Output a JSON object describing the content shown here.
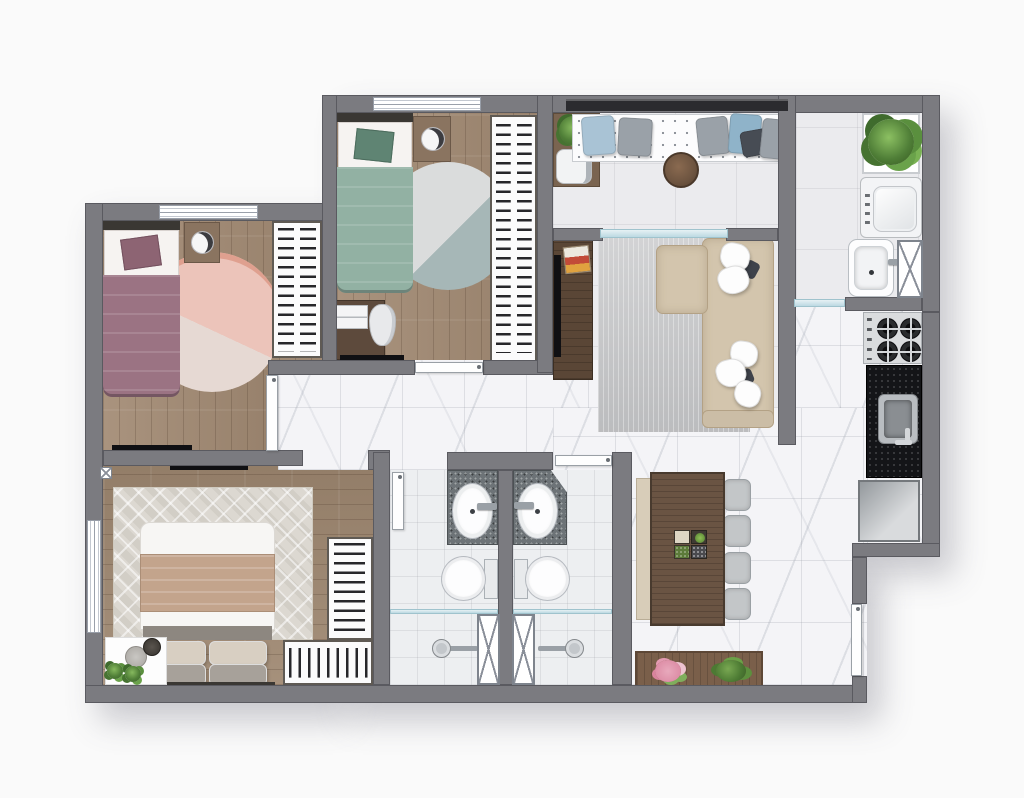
{
  "meta": {
    "type": "apartment-floor-plan",
    "view": "top-down furnished rendering",
    "canvas": {
      "width": 1024,
      "height": 798
    },
    "text_visible": "none"
  },
  "palette": {
    "background": "#fafafa",
    "walls": "#7b7b80",
    "wood_floor": "#a28a73",
    "marble_floor": "#f4f4f7",
    "plain_tile": "#ebebee",
    "bath_tile": "#edeff1",
    "bed1_mauve": "#9b7383",
    "bed2_green": "#92b1a3",
    "master_blanket_tan": "#c3a48c",
    "sofa_beige": "#d3c5ad",
    "living_rug_gray": "#c7c8ca",
    "rug_pink": "#eec6bc",
    "rug_teal": "#a6b7b7",
    "dining_table_walnut": "#6a5443",
    "granite_vanity": "#6d7377",
    "kitchen_counter_black": "#141518",
    "glass_partition": "#bcd9e2",
    "plants_green": "#4f7e37",
    "flowers_pink": "#e8a0b4"
  },
  "rooms": [
    {
      "id": "bedroom-1",
      "position": "top-left",
      "floor": "wood",
      "contents": [
        "single-bed-mauve",
        "white-pillow-with-mauve-cushion",
        "dark-headboard",
        "nightstand-with-round-lamp",
        "round-rug-pink-two-tone",
        "open-wardrobe-hanging-clothes",
        "wall-tv",
        "window-top-wall",
        "door-to-hallway"
      ]
    },
    {
      "id": "bedroom-2",
      "position": "top-middle",
      "floor": "wood",
      "contents": [
        "single-bed-green",
        "white-pillow-with-green-cushion",
        "dark-headboard",
        "nightstand-with-round-lamp",
        "round-rug-gray-teal",
        "open-wardrobe-hanging-clothes",
        "desk-with-white-chair-and-books",
        "wall-tv",
        "window-top-wall",
        "door-to-hallway"
      ]
    },
    {
      "id": "master-bedroom",
      "position": "bottom-left",
      "floor": "wood",
      "contents": [
        "double-bed-white-duvet-tan-throw",
        "beige-and-gray-pillow-pairs",
        "chevron-pattern-rug",
        "l-shaped-open-wardrobe",
        "corner-table-with-two-plants-and-trays",
        "wall-tv",
        "window-left-wall",
        "door-to-hallway"
      ]
    },
    {
      "id": "hallway",
      "position": "center",
      "floor": "marble",
      "contents": []
    },
    {
      "id": "bathroom-1",
      "position": "bottom-center-left",
      "floor": "tile",
      "contents": [
        "granite-vanity-with-oval-sink",
        "toilet",
        "shower-with-glass-partition",
        "shower-head",
        "x-window-panel",
        "door"
      ]
    },
    {
      "id": "bathroom-2",
      "position": "bottom-center",
      "floor": "tile",
      "contents": [
        "granite-vanity-with-oval-sink-clipped-corner",
        "toilet",
        "shower-with-glass-partition",
        "shower-head",
        "x-window-panel",
        "door"
      ]
    },
    {
      "id": "living-room",
      "position": "center-right",
      "floor": "tile-and-marble",
      "contents": [
        "l-shaped-beige-sofa",
        "white-throw-pillows",
        "gray-area-rug",
        "tv-cabinet-walnut",
        "wall-tv",
        "decor-tray"
      ]
    },
    {
      "id": "balcony",
      "position": "top-right",
      "floor": "tile",
      "contents": [
        "bench-with-dotted-mattress",
        "six-cushions-blue-gray-dark",
        "round-walnut-table",
        "console-with-plant-and-coffee-maker",
        "dark-glass-railing",
        "sliding-glass-door"
      ]
    },
    {
      "id": "laundry-area",
      "position": "right",
      "floor": "tile",
      "contents": [
        "planter-niche-large-plant",
        "top-load-washing-machine",
        "laundry-tub-with-faucet",
        "x-window-panel",
        "glass-partition-to-kitchen"
      ]
    },
    {
      "id": "kitchen",
      "position": "right",
      "floor": "marble",
      "contents": [
        "gas-cooktop-4-burners",
        "black-granite-counter",
        "stainless-sink-with-faucet",
        "base-cabinet"
      ]
    },
    {
      "id": "dining-area",
      "position": "bottom-right",
      "floor": "marble",
      "contents": [
        "walnut-table",
        "beige-bench",
        "four-gray-chairs",
        "centerpiece-four-trays",
        "planter-box-pink-flowers-and-shrub"
      ]
    },
    {
      "id": "entry",
      "position": "bottom-right-wall",
      "contents": [
        "entrance-door"
      ]
    }
  ],
  "counts": {
    "bedrooms": 3,
    "bathrooms": 2,
    "dining_chairs": 4,
    "cooktop_burners": 4,
    "balcony_cushions": 6,
    "sofa_pillows": 5
  }
}
